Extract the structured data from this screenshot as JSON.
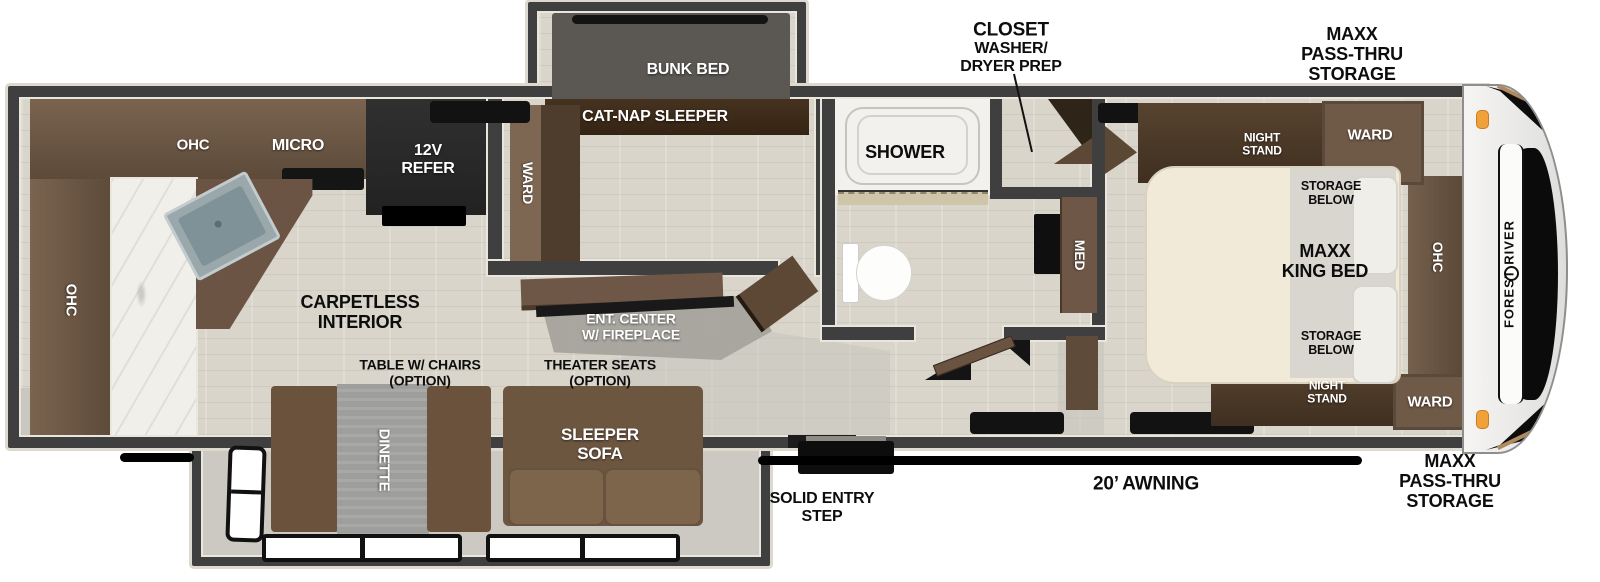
{
  "floorplan": {
    "brand": "FOREST RIVER",
    "callouts": {
      "closet_title": "CLOSET",
      "closet_sub": "WASHER/\nDRYER PREP",
      "pass_thru_top": "MAXX\nPASS-THRU\nSTORAGE",
      "pass_thru_bottom": "MAXX\nPASS-THRU\nSTORAGE",
      "awning": "20’ AWNING",
      "entry_step": "SOLID ENTRY\nSTEP"
    },
    "bedroom": {
      "king_bed": "MAXX\nKING BED",
      "storage_below_top": "STORAGE\nBELOW",
      "storage_below_bottom": "STORAGE\nBELOW",
      "night_stand_top": "NIGHT\nSTAND",
      "night_stand_bottom": "NIGHT\nSTAND",
      "ward_top": "WARD",
      "ward_bottom": "WARD",
      "ohc": "OHC"
    },
    "bath": {
      "shower": "SHOWER",
      "med": "MED"
    },
    "bunk_room": {
      "bunk_bed": "BUNK BED",
      "cat_nap": "CAT-NAP SLEEPER",
      "ward": "WARD"
    },
    "kitchen": {
      "ohc_top": "OHC",
      "micro": "MICRO",
      "refer": "12V\nREFER",
      "ohc_left": "OHC"
    },
    "living": {
      "carpetless": "CARPETLESS\nINTERIOR",
      "ent_center": "ENT. CENTER\nW/ FIREPLACE",
      "table_option": "TABLE W/ CHAIRS\n(OPTION)",
      "theater_option": "THEATER SEATS\n(OPTION)",
      "dinette": "DINETTE",
      "sleeper_sofa": "SLEEPER\nSOFA"
    }
  }
}
